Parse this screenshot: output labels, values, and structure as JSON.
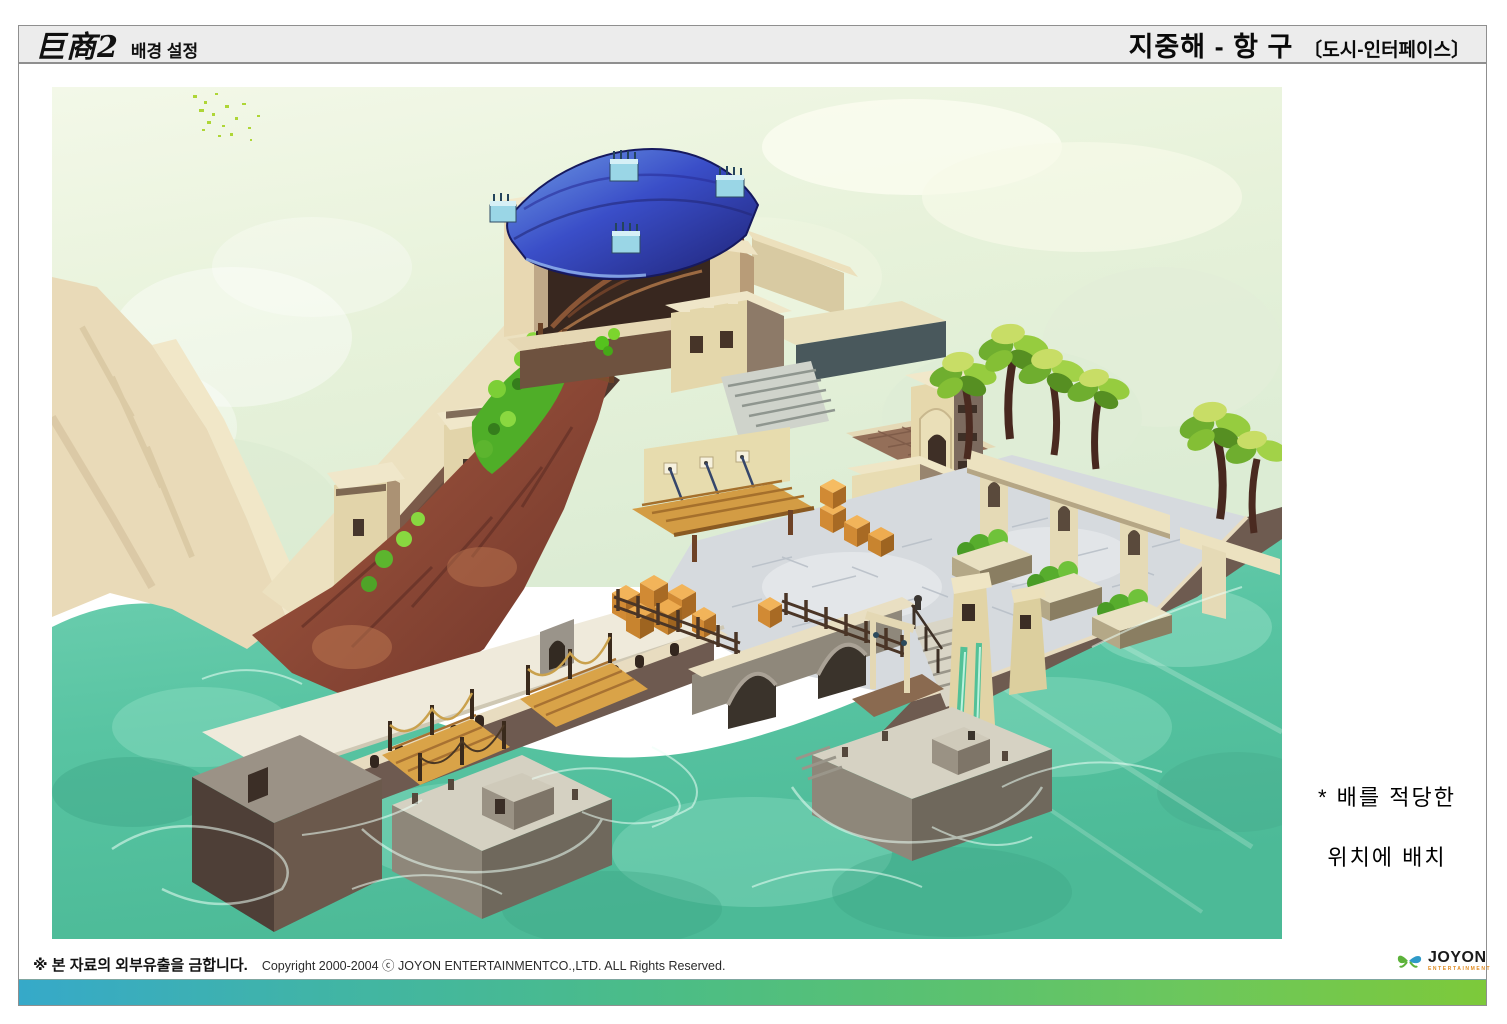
{
  "header": {
    "title_main": "巨商2",
    "title_sub": "배경 설정",
    "section_title": "지중해 - 항 구",
    "section_sub": "〔도시-인터페이스〕"
  },
  "annotation": {
    "line1": "* 배를 적당한",
    "line2": "위치에 배치"
  },
  "footer": {
    "notice": "※ 본 자료의 외부유출을 금합니다.",
    "copyright": "Copyright 2000-2004 ⓒ JOYON ENTERTAINMENTCO.,LTD. ALL Rights Reserved.",
    "logo_name": "JOYON",
    "logo_sub": "ENTERTAINMENT"
  },
  "artwork_palette": {
    "sky": "#ecf5df",
    "water": "#5ec7a8",
    "roof_blue": "#3346c0",
    "cliff_red": "#9a5340",
    "stone_cream": "#e8dcb2",
    "dock_brown": "#6e5a50",
    "wood_plank": "#d49c44",
    "foliage": "#6fbe33",
    "gradient_bar_left": "#36a9c9",
    "gradient_bar_right": "#7dc93a"
  }
}
